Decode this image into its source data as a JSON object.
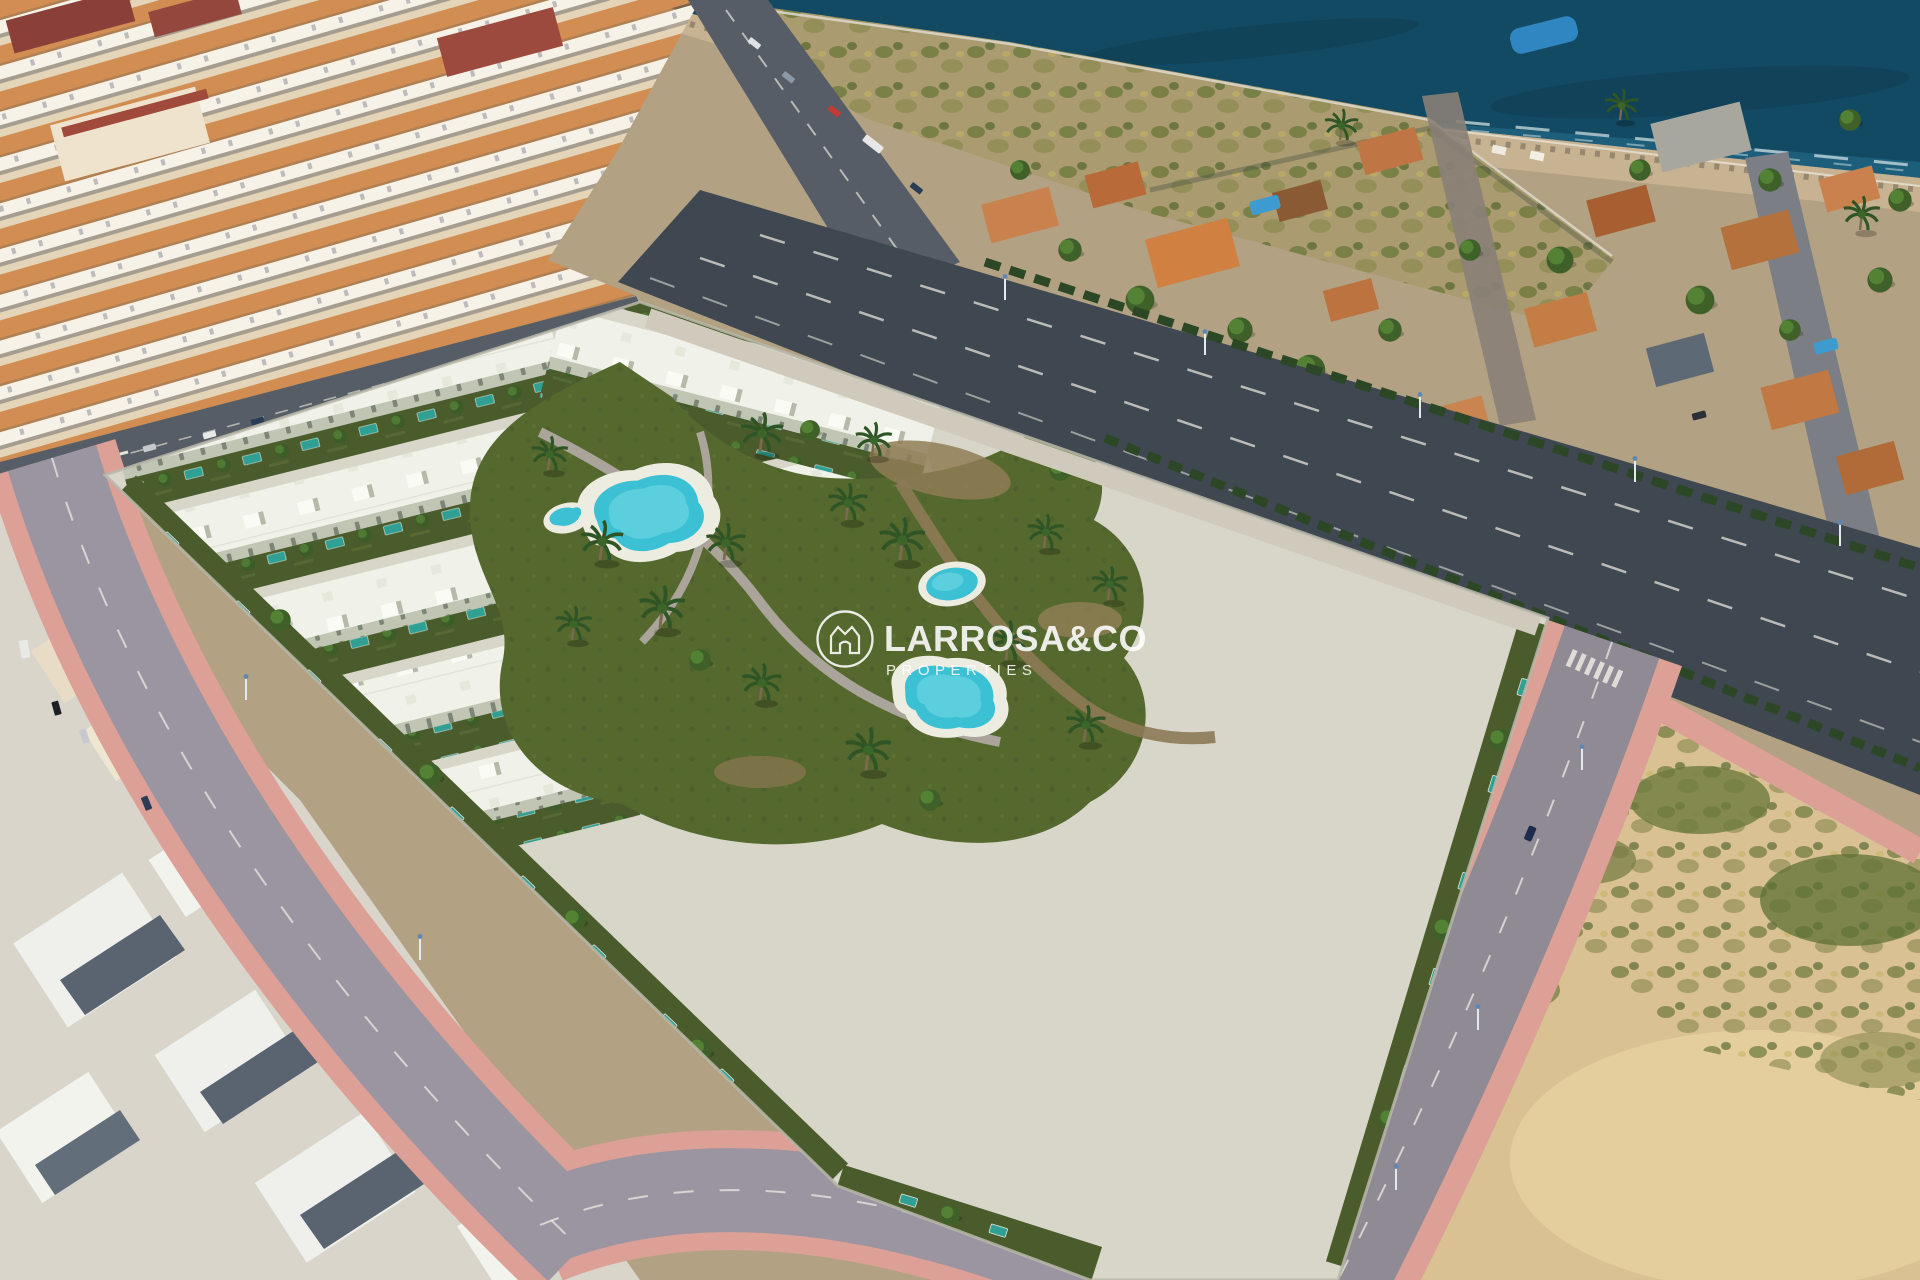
{
  "watermark": {
    "brand": "LARROSA&CO",
    "tagline": "PROPERTIES",
    "icon": "crown-house-in-circle",
    "text_color": "#ffffff",
    "opacity": 0.85
  },
  "colors": {
    "sea": "#134a63",
    "sea_shallow": "#2b7a99",
    "foam": "#e9f2f2",
    "beach": "#c7b291",
    "rocks": "#6f6552",
    "scrub_field": "#ab9b70",
    "villa_ground": "#b2a183",
    "villa_roof": "#c9824d",
    "villa_roof_dark": "#a75f31",
    "villa_pool": "#3e9bd0",
    "tree_green": "#3f662f",
    "tree_dark": "#2e4d27",
    "town_base": "#ecdcc2",
    "town_roof": "#d28d52",
    "town_wall": "#f6f2e7",
    "town_red_roof": "#8a4038",
    "town_road": "#565d66",
    "avenue_asphalt": "#3f4750",
    "lane_marking": "#d8d8d2",
    "hedge": "#2c4726",
    "street_asphalt": "#9b95a1",
    "sidewalk_pink": "#dca096",
    "dev_concrete": "#d7d6c9",
    "dev_roof": "#f0f1e8",
    "dev_roof_bright": "#fbfbf5",
    "dev_wall": "#c0c5b4",
    "dev_window": "#76806f",
    "yard_green": "#4a5c2c",
    "yard_pool_teal": "#2fa093",
    "garden_green": "#55682e",
    "garden_path": "#aaa49a",
    "dirt_path": "#8f7c55",
    "pool_deck": "#edece0",
    "pool_water": "#3cc0d4",
    "pool_water_light": "#7adde8",
    "lot_sand": "#d9c194",
    "lot_scrub": "#5e7036",
    "old_town_ground": "#d9d5cb",
    "old_roof_face": "#5a6470",
    "white_roof": "#eff0ec",
    "car_navy": "#1d2b4e"
  }
}
